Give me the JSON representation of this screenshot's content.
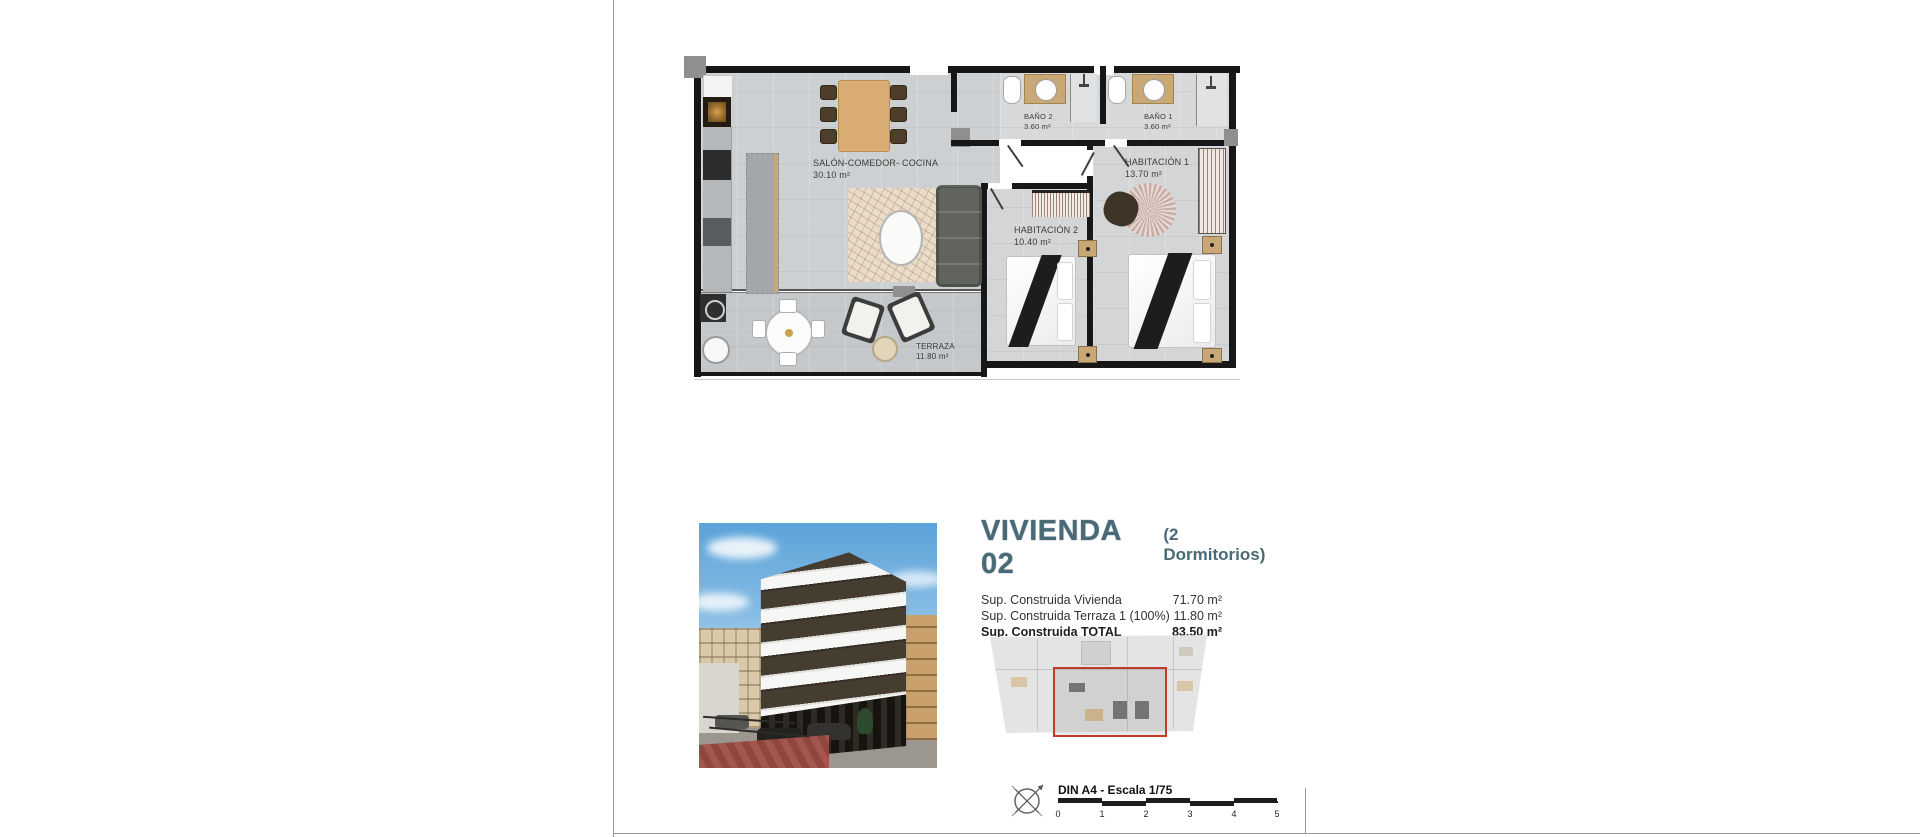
{
  "sheet": {
    "scale_label": "DIN A4 - Escala 1/75",
    "scale_ticks": [
      "0",
      "1",
      "2",
      "3",
      "4",
      "5"
    ]
  },
  "floor_plan": {
    "rooms": [
      {
        "name": "SALÓN-COMEDOR- COCINA",
        "area": "30.10 m²"
      },
      {
        "name": "BAÑO 2",
        "area": "3.60 m²"
      },
      {
        "name": "BAÑO 1",
        "area": "3.60 m²"
      },
      {
        "name": "HABITACIÓN 1",
        "area": "13.70 m²"
      },
      {
        "name": "HABITACIÓN 2",
        "area": "10.40 m²"
      },
      {
        "name": "TERRAZA",
        "area": "11.80 m²"
      }
    ]
  },
  "unit": {
    "title": "VIVIENDA 02",
    "subtitle": "(2 Dormitorios)",
    "surfaces": [
      {
        "label": "Sup. Construida Vivienda",
        "value": "71.70 m²"
      },
      {
        "label": "Sup. Construida Terraza 1 (100%)",
        "value": "11.80 m²"
      },
      {
        "label": "Sup. Construida TOTAL",
        "value": "83.50 m²"
      }
    ]
  },
  "colors": {
    "title_teal": "#4a6a77",
    "highlight_red": "#c33a28",
    "wall_black": "#171717",
    "floor_gray": "#cdd0d2",
    "wood_tan": "#d8ac72"
  }
}
